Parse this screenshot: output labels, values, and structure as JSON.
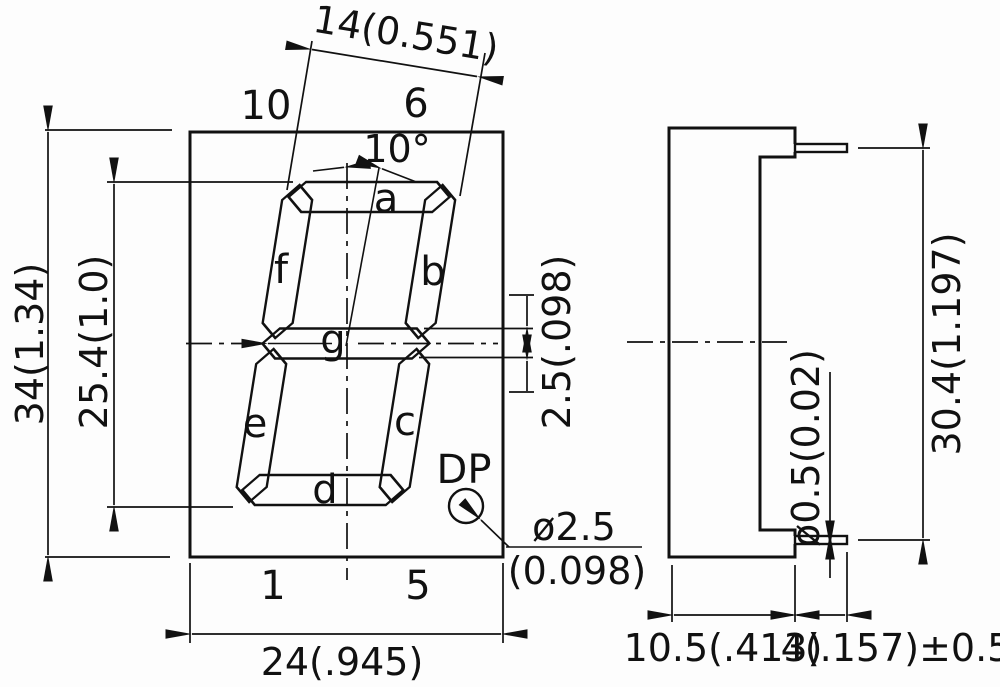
{
  "front": {
    "dim_width_top": "14(0.551)",
    "pin_top_left": "10",
    "pin_top_right": "6",
    "angle": "10°",
    "dim_height_overall": "34(1.34)",
    "dim_height_digit": "25.4(1.0)",
    "dim_seg_thickness": "2.5(.098)",
    "seg_a": "a",
    "seg_b": "b",
    "seg_c": "c",
    "seg_d": "d",
    "seg_e": "e",
    "seg_f": "f",
    "seg_g": "g",
    "dp_label": "DP",
    "dim_dp_dia": "ø2.5",
    "dim_dp_dia_inch": "(0.098)",
    "pin_bottom_left": "1",
    "pin_bottom_right": "5",
    "dim_width_bottom": "24(.945)"
  },
  "side": {
    "dim_pin_row_spacing": "30.4(1.197)",
    "dim_pin_dia": "ø0.5(0.02)",
    "dim_body_depth": "10.5(.413)",
    "dim_pin_length": "4(.157)±0.5"
  }
}
